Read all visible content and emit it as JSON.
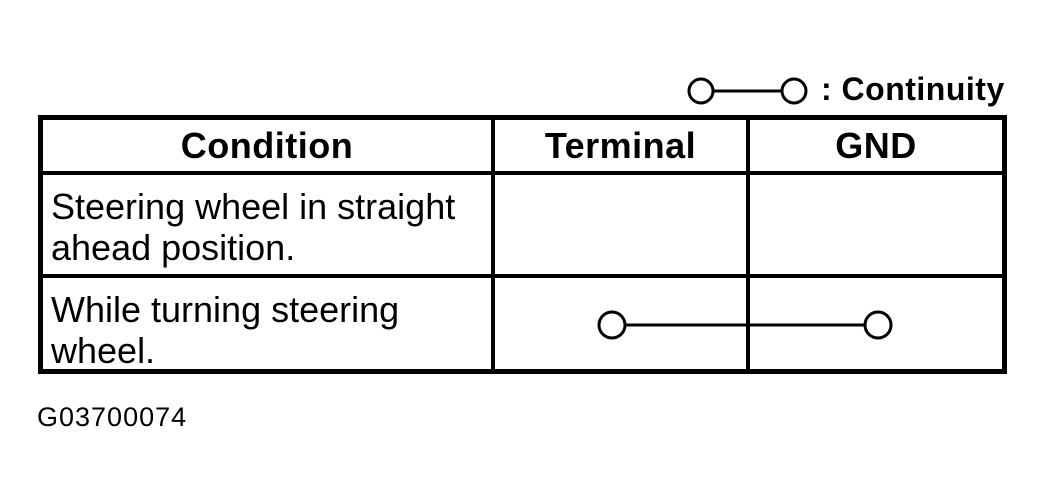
{
  "page": {
    "background": "#ffffff",
    "ink": "#000000"
  },
  "legend": {
    "symbol": "circle-line-circle",
    "label": ": Continuity"
  },
  "table": {
    "headers": [
      "Condition",
      "Terminal",
      "GND"
    ],
    "rows": [
      {
        "condition": "Steering wheel in straight ahead position.",
        "terminal_to_gnd": "no continuity symbol (blank)"
      },
      {
        "condition": "While turning steering wheel.",
        "terminal_to_gnd": "continuity"
      }
    ]
  },
  "figure_code": "G03700074"
}
